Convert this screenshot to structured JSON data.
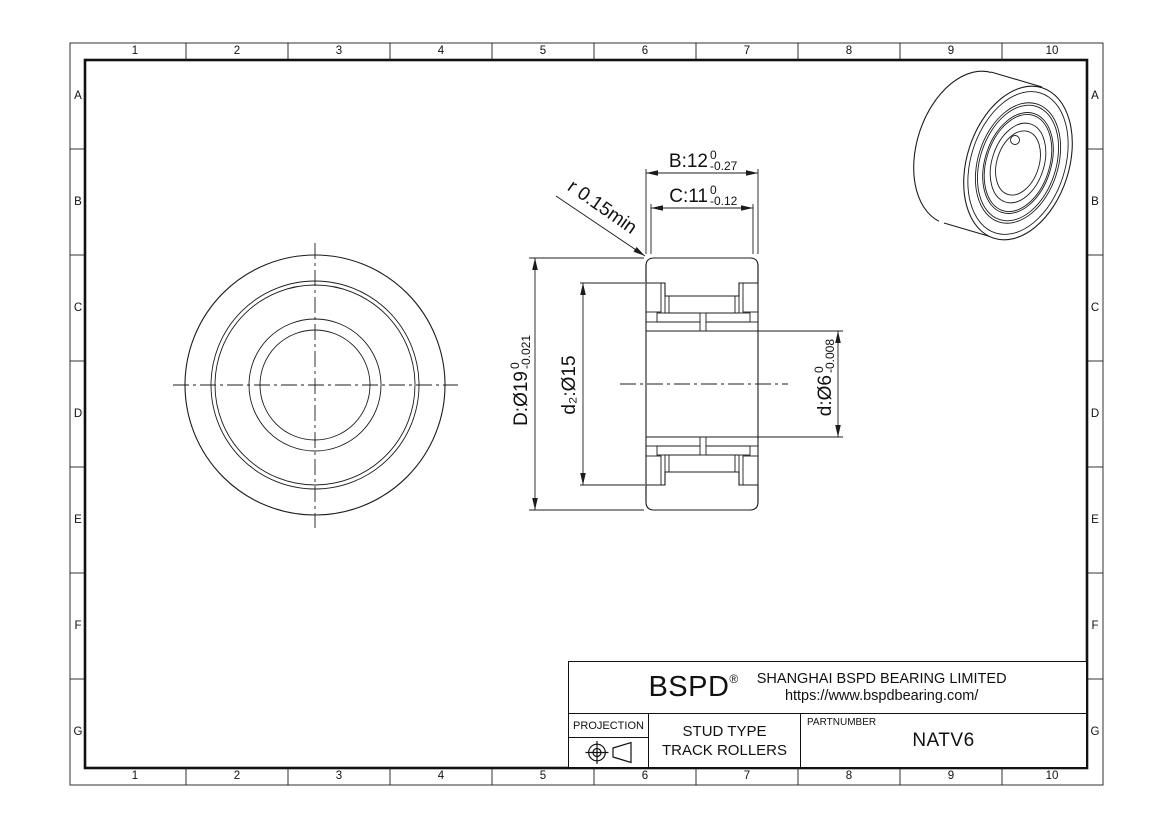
{
  "sheet": {
    "background": "#ffffff",
    "line_color": "#1c1c1c"
  },
  "grid": {
    "columns": [
      "1",
      "2",
      "3",
      "4",
      "5",
      "6",
      "7",
      "8",
      "9",
      "10"
    ],
    "rows": [
      "A",
      "B",
      "C",
      "D",
      "E",
      "F",
      "G"
    ]
  },
  "dimensions": {
    "B": {
      "text": "B:12",
      "tol_upper": "0",
      "tol_lower": "-0.27"
    },
    "C": {
      "text": "C:11",
      "tol_upper": "0",
      "tol_lower": "-0.12"
    },
    "D": {
      "text": "D:Ø19",
      "tol_upper": "0",
      "tol_lower": "-0.021"
    },
    "d2": {
      "text": "d₂:Ø15"
    },
    "d": {
      "text": "d:Ø6",
      "tol_upper": "0",
      "tol_lower": "-0.008"
    },
    "r": {
      "text": "r 0.15min"
    }
  },
  "title_block": {
    "logo": "BSPD",
    "registered_mark": "®",
    "company": "SHANGHAI BSPD BEARING LIMITED",
    "website": "https://www.bspdbearing.com/",
    "projection_label": "PROJECTION",
    "product_line1": "STUD TYPE",
    "product_line2": "TRACK ROLLERS",
    "partnumber_label": "PARTNUMBER",
    "partnumber": "NATV6"
  }
}
